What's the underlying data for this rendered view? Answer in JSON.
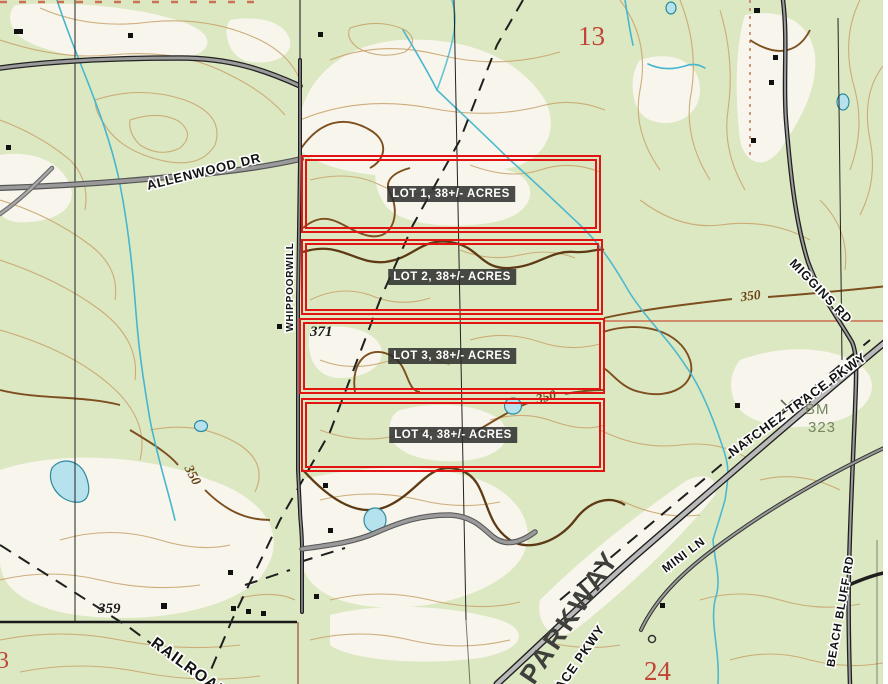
{
  "map": {
    "description": "USGS-style topographic plat map showing four surveyed lots",
    "sections": {
      "north": "13",
      "south": "24",
      "west_partial": "3"
    },
    "elevations": {
      "spot_center": "371",
      "spot_southwest": "359"
    },
    "contour_labels": {
      "west": "350",
      "east": "350",
      "center": "350"
    },
    "benchmark": {
      "abbr": "BM",
      "value": "323"
    },
    "roads": {
      "allenwood": "ALLENWOOD DR",
      "whippoorwill": "WHIPPOORWILL",
      "miggins": "MIGGINS RD",
      "natchez": "NATCHEZ TRACE PKWY",
      "parkway_large": "PARKWAY",
      "trace": "TRACE PKWY",
      "mini": "MINI LN",
      "beach_bluff": "BEACH BLUFF RD",
      "railroad": "RAILROAD"
    },
    "lots": [
      {
        "label": "LOT 1, 38+/- ACRES"
      },
      {
        "label": "LOT 2, 38+/- ACRES"
      },
      {
        "label": "LOT 3, 38+/- ACRES"
      },
      {
        "label": "LOT 4, 38+/- ACRES"
      }
    ],
    "colors": {
      "map_background": "#dce8c2",
      "cleared_land": "#f7f5ec",
      "contour_light": "#c9a56f",
      "contour_index": "#7d4e1e",
      "water": "#45b6cf",
      "pond_fill": "#b5e2ec",
      "road_gray": "#9a9a9a",
      "road_casing": "#1f1f1f",
      "boundary_red": "#c8553a",
      "lot_outline": "#e31313",
      "lot_label_bg": "rgba(43,43,43,0.85)",
      "section_number": "#bf4636",
      "benchmark_text": "#74855f"
    }
  }
}
